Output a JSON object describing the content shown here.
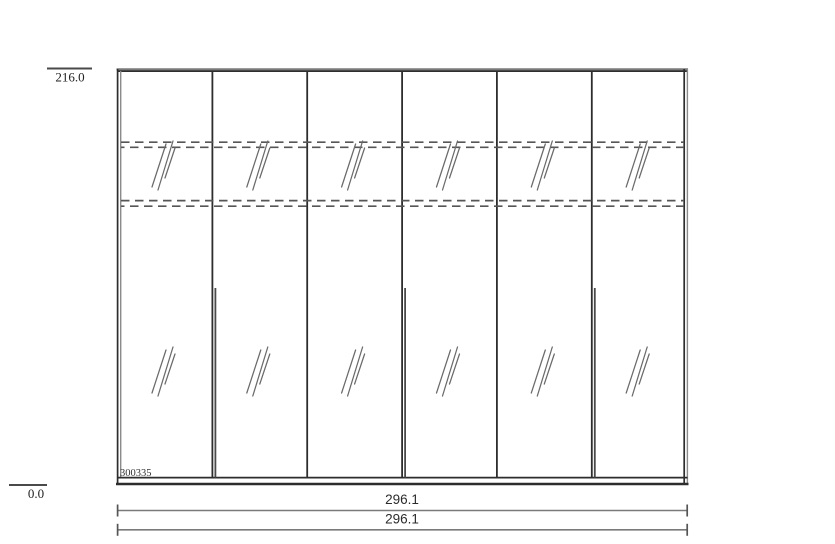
{
  "page": {
    "background": "#ffffff",
    "description": "Wardrobe elevation technical drawing with six mirrored doors"
  },
  "labels": {
    "height_top": "216.0",
    "height_bottom": "0.0",
    "item_code": "300335"
  },
  "dimensions": {
    "width_primary": "296.1",
    "width_secondary": "296.1"
  },
  "structure": {
    "door_count": 6,
    "glass_hatches_per_door": 2,
    "dashed_shelf_lines": 2,
    "handle_bars": 3
  },
  "colors": {
    "line_dark": "#2d2d2d",
    "line_gray": "#7a7a7a",
    "dashed_line": "#565656",
    "hatch": "#6a6a6a",
    "dimension_line": "#7a7a7a",
    "text": "#222222"
  }
}
